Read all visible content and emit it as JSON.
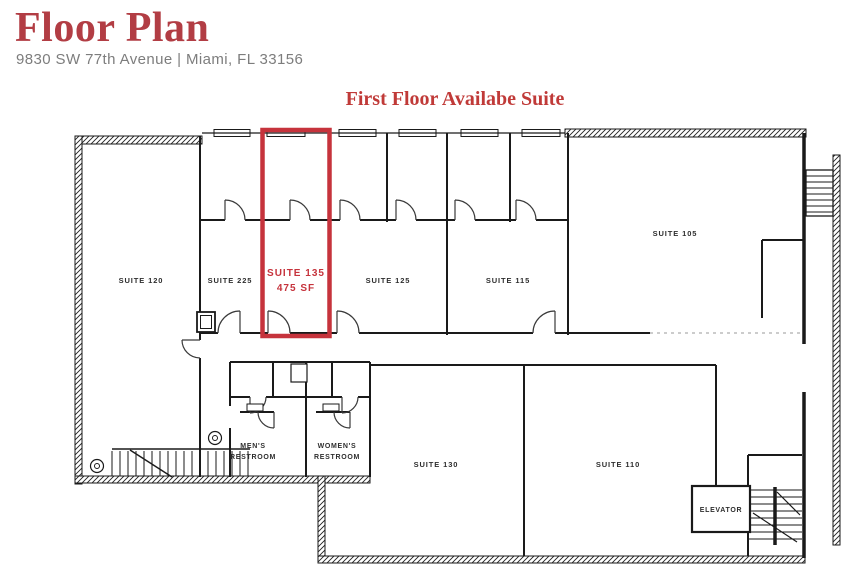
{
  "header": {
    "title": "Floor Plan",
    "address": "9830 SW 77th Avenue | Miami, FL 33156",
    "plan_heading": "First Floor Availabe Suite"
  },
  "colors": {
    "title_red": "#b23d44",
    "heading_red": "#c03a38",
    "highlight_red": "#c6333c",
    "address_gray": "#7d7d7d",
    "label_color": "#2e2e2e",
    "wall_color": "#1a1a1a"
  },
  "floor_plan": {
    "highlighted_suite": {
      "name": "SUITE 135",
      "area": "475 SF"
    },
    "suites": [
      {
        "label": "SUITE 120"
      },
      {
        "label": "SUITE 225"
      },
      {
        "label": "SUITE 125"
      },
      {
        "label": "SUITE 115"
      },
      {
        "label": "SUITE 105"
      },
      {
        "label": "SUITE 130"
      },
      {
        "label": "SUITE 110"
      }
    ],
    "rooms": {
      "mens_line1": "MEN'S",
      "mens_line2": "RESTROOM",
      "womens_line1": "WOMEN'S",
      "womens_line2": "RESTROOM",
      "elevator": "ELEVATOR"
    }
  }
}
